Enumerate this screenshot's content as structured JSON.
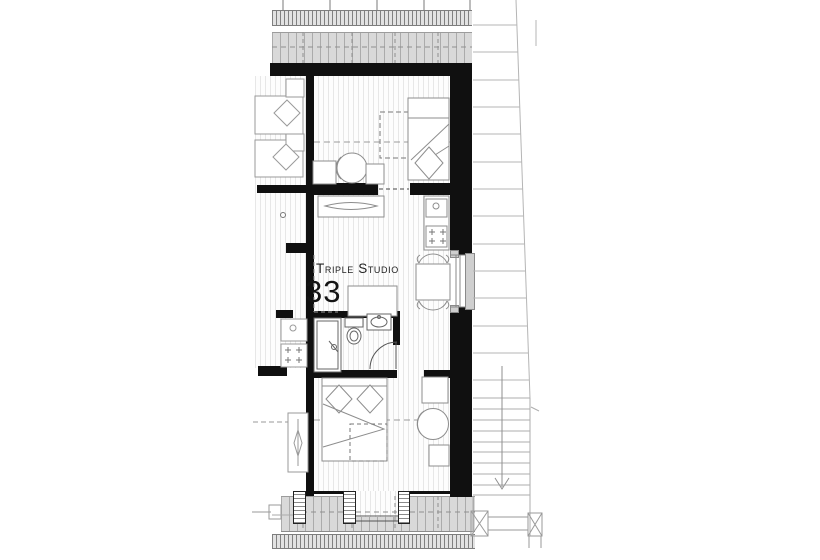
{
  "plan": {
    "unit_label": "Triple Studio",
    "unit_number": "33"
  },
  "colors": {
    "background": "#ffffff",
    "wall": "#101010",
    "roof_band_fill": "#d9d9d9",
    "roof_band_line": "#ababab",
    "eaves_band_fill": "#e2e2e2",
    "floor_line": "#e7e7e7",
    "furniture_line": "#8d8d8d",
    "fixture_line": "#666666",
    "exterior_line": "#b5b5b5",
    "text": "#222222"
  }
}
